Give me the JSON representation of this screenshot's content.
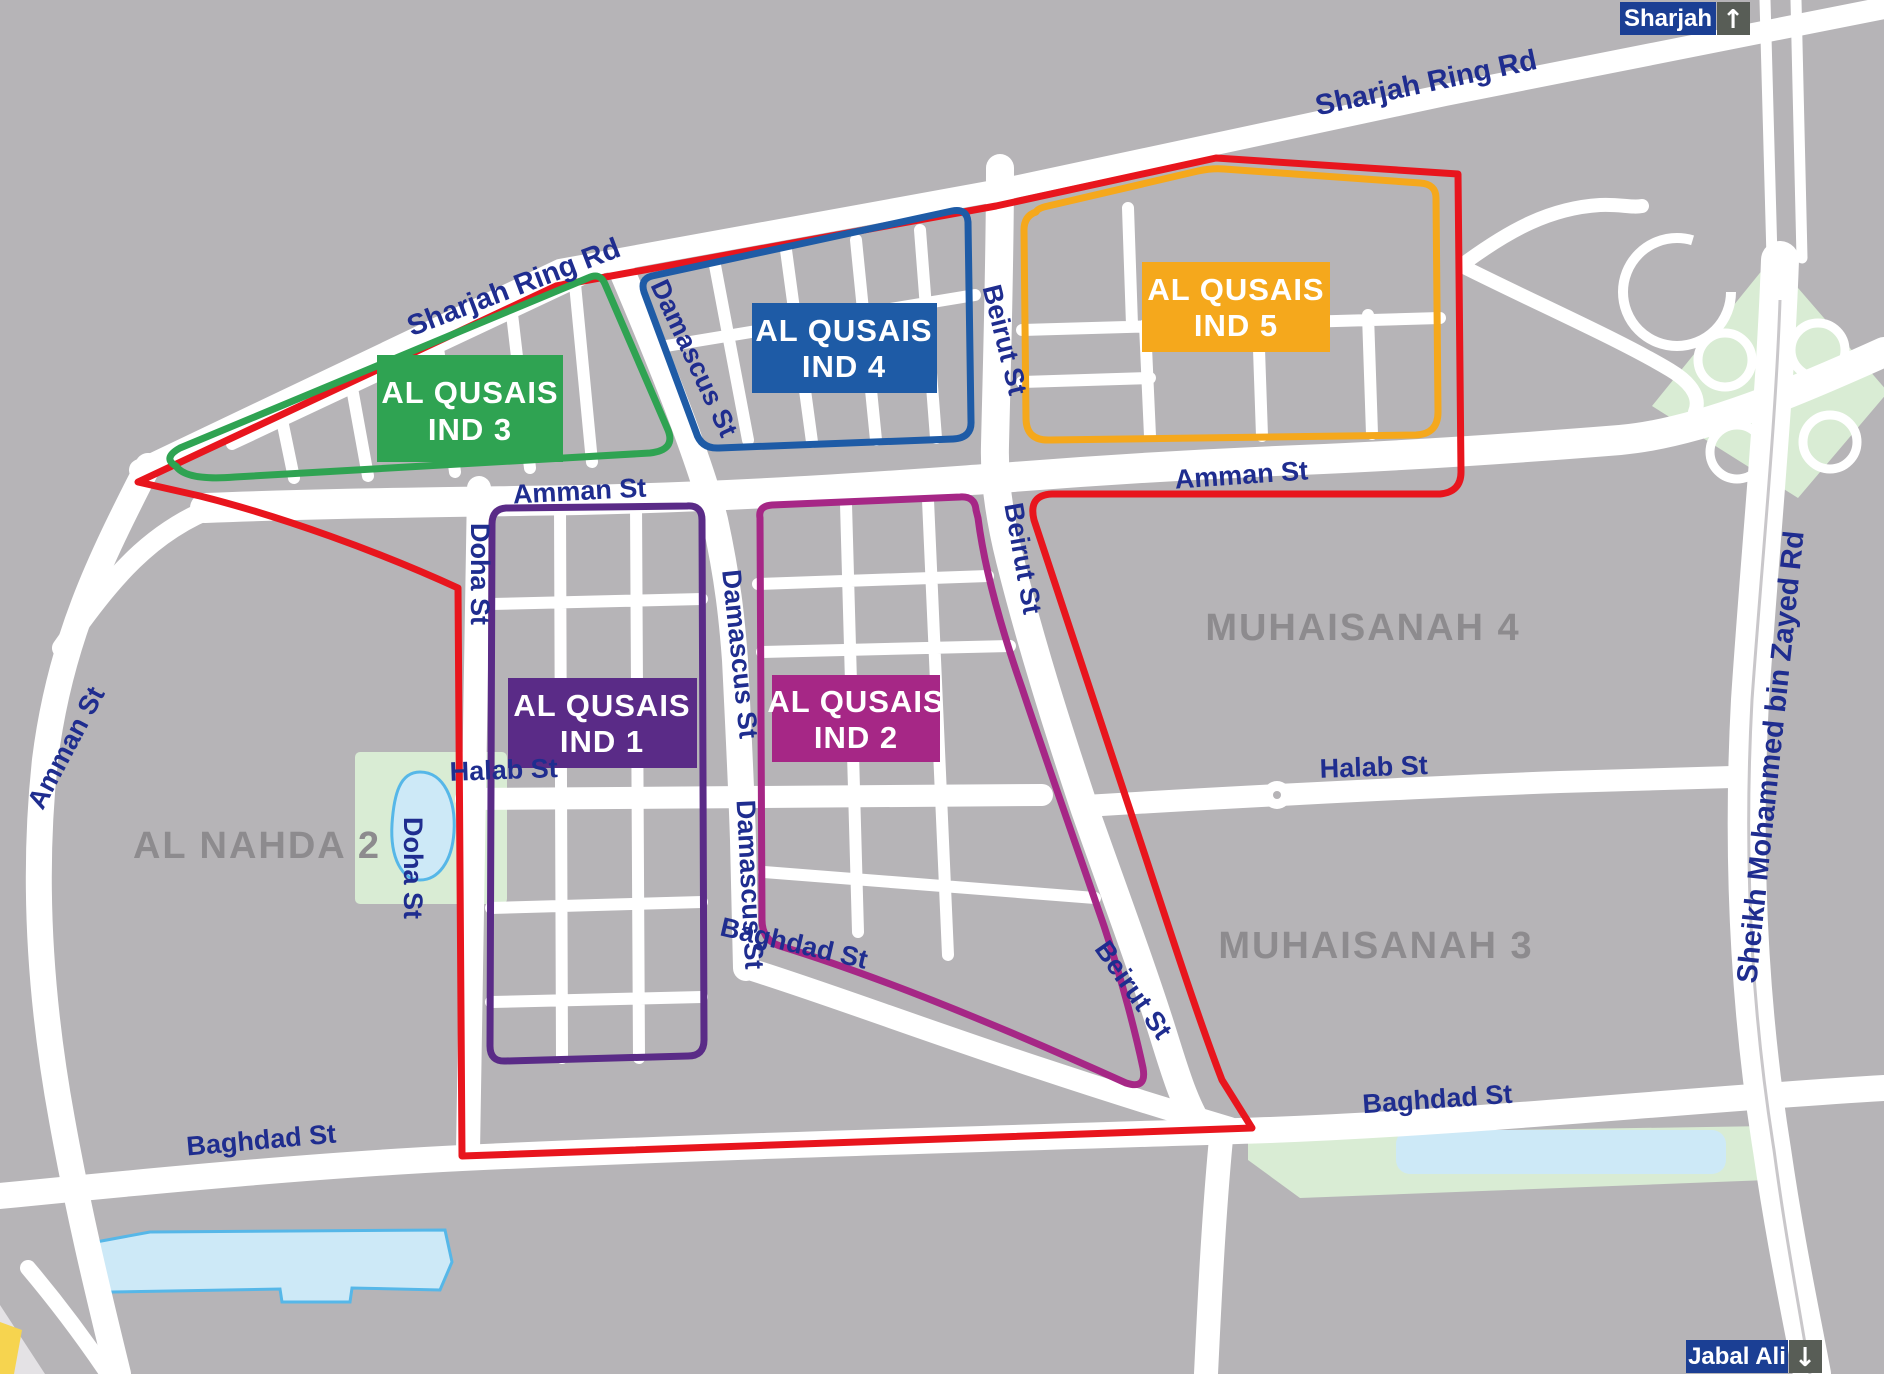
{
  "streets": {
    "sharjah_ring": "Sharjah Ring Rd",
    "damascus": "Damascus St",
    "beirut": "Beirut St",
    "amman": "Amman St",
    "doha": "Doha St",
    "halab": "Halab St",
    "baghdad": "Baghdad St",
    "smbz": "Sheikh Mohammed bin Zayed Rd"
  },
  "areas": {
    "muhaisanah4": "MUHAISANAH 4",
    "muhaisanah3": "MUHAISANAH 3",
    "al_nahda2": "AL NAHDA 2"
  },
  "zones": [
    {
      "line1": "AL QUSAIS",
      "line2": "IND 1",
      "color": "#5a2b87"
    },
    {
      "line1": "AL QUSAIS",
      "line2": "IND 2",
      "color": "#a62786"
    },
    {
      "line1": "AL QUSAIS",
      "line2": "IND 3",
      "color": "#2fa352"
    },
    {
      "line1": "AL QUSAIS",
      "line2": "IND 4",
      "color": "#1e5ba6"
    },
    {
      "line1": "AL QUSAIS",
      "line2": "IND 5",
      "color": "#f5a81c"
    }
  ],
  "badges": {
    "sharjah": {
      "label": "Sharjah",
      "arrow": "↑"
    },
    "jabal_ali": {
      "label": "Jabal Ali",
      "arrow": "↓"
    }
  },
  "colors": {
    "map_bg": "#b6b4b7",
    "road": "#ffffff",
    "boundary_red": "#e8151d",
    "road_label_blue": "#1f2d8f",
    "area_label_gray": "#8d8b8e",
    "park_green": "#d9ecd4",
    "water_fill": "#cde9f7",
    "water_stroke": "#56b7e8",
    "sand_yellow": "#f6d44f",
    "badge_blue": "#1b3f94",
    "badge_gray": "#585d56"
  }
}
